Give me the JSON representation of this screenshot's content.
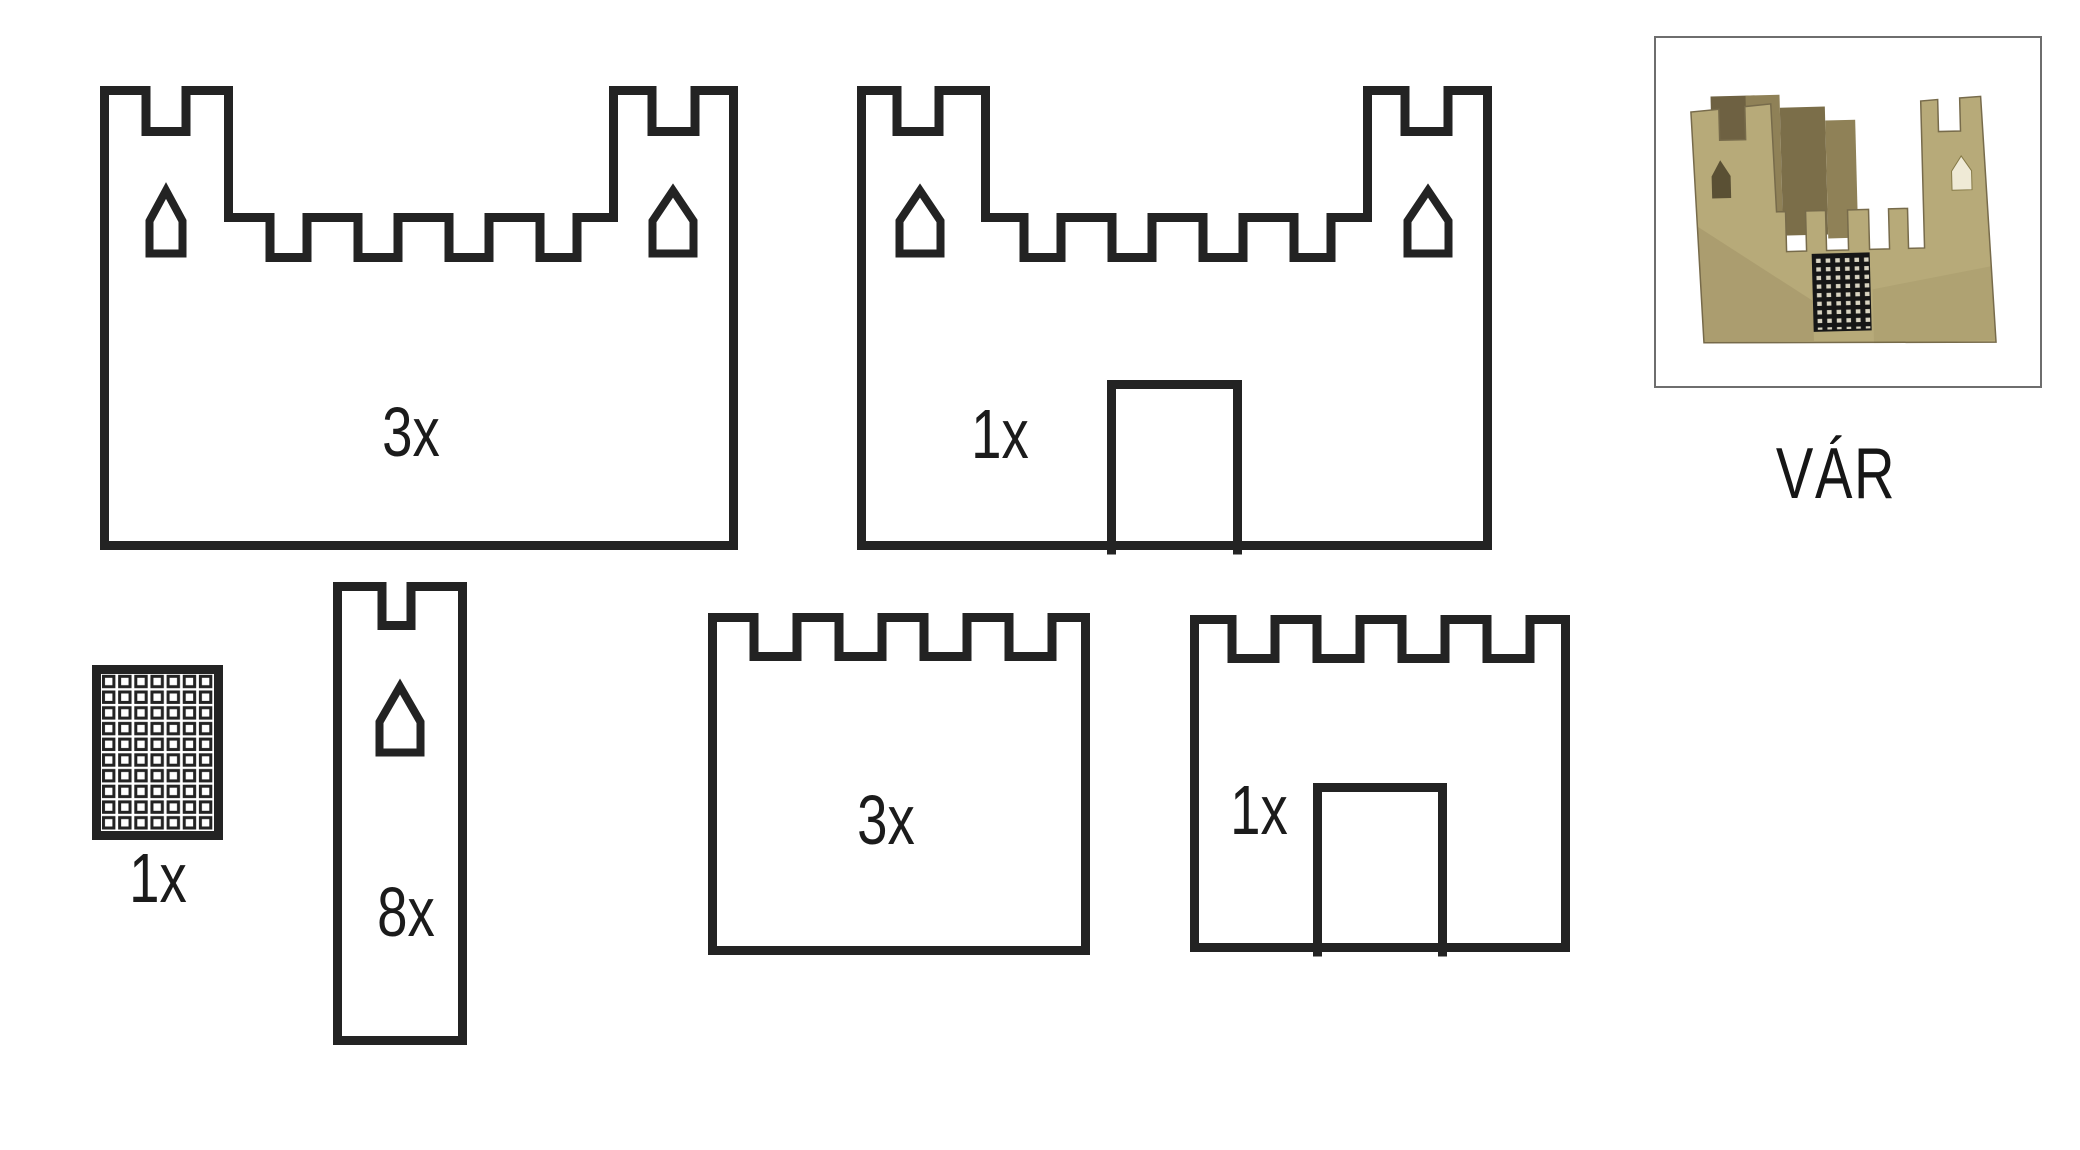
{
  "page": {
    "background": "#ffffff"
  },
  "kit": {
    "name_label": "VÁR",
    "pieces": [
      {
        "id": "outer-wall-with-towers",
        "quantity_label": "3x"
      },
      {
        "id": "outer-wall-with-towers-and-gate",
        "quantity_label": "1x"
      },
      {
        "id": "portcullis-grille",
        "quantity_label": "1x"
      },
      {
        "id": "tower-strip",
        "quantity_label": "8x"
      },
      {
        "id": "battlement-wall",
        "quantity_label": "3x"
      },
      {
        "id": "battlement-wall-with-gate",
        "quantity_label": "1x"
      }
    ]
  },
  "colors": {
    "outline": "#232323",
    "label_text": "#1b1b1b",
    "photo_frame_border": "#6e6e6e",
    "cardboard_base": "#b7aa79",
    "cardboard_shadow": "#7b6e49",
    "cardboard_flap": "#8f8157",
    "portcullis_black": "#161616"
  }
}
